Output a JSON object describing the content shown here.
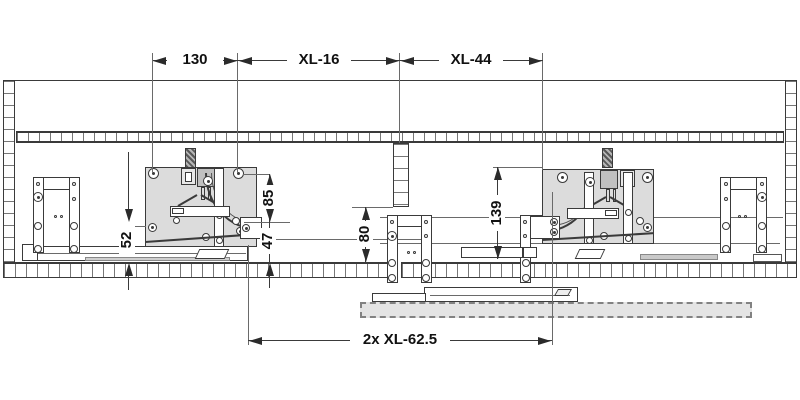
{
  "dims": {
    "d130": "130",
    "xl16": "XL-16",
    "xl44": "XL-44",
    "d52": "52",
    "d85": "85",
    "d47": "47",
    "d80": "80",
    "d139": "139",
    "bottom": "2x XL-62.5"
  },
  "colors": {
    "line": "#3a3a3a",
    "fitting_fill": "#dcdcdc",
    "door_dashed_fill": "#e4e4e4",
    "background": "#ffffff"
  }
}
